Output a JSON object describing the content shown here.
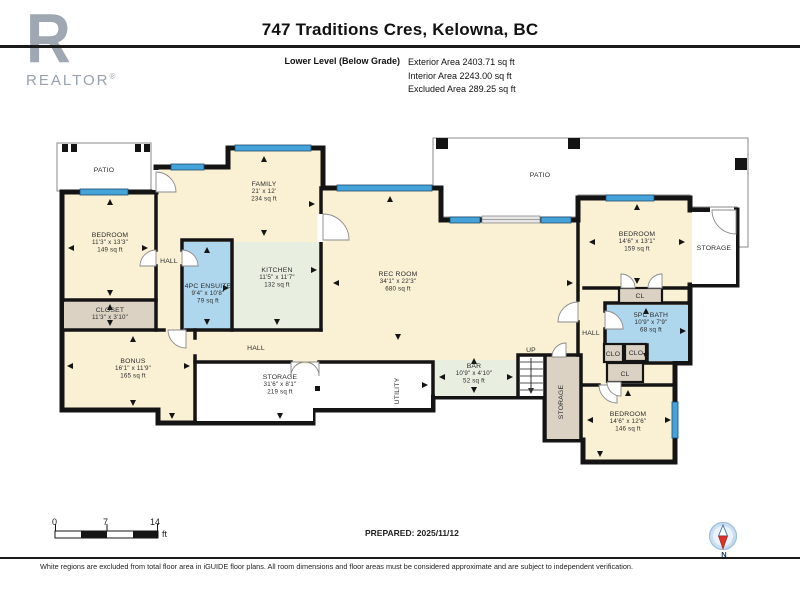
{
  "header": {
    "brand": "REALTOR",
    "brand_reg": "®",
    "brand_r": "R",
    "title": "747 Traditions Cres, Kelowna, BC",
    "level_label": "Lower Level (Below Grade)",
    "areas": [
      {
        "label": "Exterior Area",
        "value": "2403.71 sq ft"
      },
      {
        "label": "Interior Area",
        "value": "2243.00 sq ft"
      },
      {
        "label": "Excluded Area",
        "value": "289.25 sq ft"
      }
    ]
  },
  "floorplan": {
    "colors": {
      "wall": "#141414",
      "interior": "#FAF1D4",
      "wet_room": "#AED7EE",
      "kitchen_bar": "#E8EFE1",
      "closet": "#DBD2C3",
      "excluded": "#FFFFFF",
      "window": "#44A3D8",
      "sliding_door": "#E6E6E6"
    },
    "rooms": [
      {
        "name": "PATIO",
        "x": 104,
        "y": 172,
        "fs": 6.5
      },
      {
        "name": "PATIO",
        "x": 540,
        "y": 177,
        "fs": 6.5
      },
      {
        "name": "BEDROOM",
        "dims": "11'3\" x 13'3\"",
        "area": "149 sq ft",
        "x": 110,
        "y": 237
      },
      {
        "name": "HALL",
        "x": 169,
        "y": 263
      },
      {
        "name": "CLOSET",
        "dims": "11'3\" x 3'10\"",
        "x": 110,
        "y": 312
      },
      {
        "name": "4PC ENSUITE",
        "dims": "9'4\" x 10'8\"",
        "area": "79 sq ft",
        "x": 208,
        "y": 288
      },
      {
        "name": "KITCHEN",
        "dims": "11'5\" x 11'7\"",
        "area": "132 sq ft",
        "x": 277,
        "y": 272
      },
      {
        "name": "FAMILY",
        "dims": "21' x 12'",
        "area": "234 sq ft",
        "x": 264,
        "y": 186
      },
      {
        "name": "REC ROOM",
        "dims": "34'1\" x 22'3\"",
        "area": "680 sq ft",
        "x": 398,
        "y": 276
      },
      {
        "name": "BONUS",
        "dims": "16'1\" x 11'9\"",
        "area": "165 sq ft",
        "x": 133,
        "y": 363
      },
      {
        "name": "HALL",
        "x": 256,
        "y": 350
      },
      {
        "name": "STORAGE",
        "dims": "31'6\" x 8'1\"",
        "area": "219 sq ft",
        "x": 280,
        "y": 379
      },
      {
        "name": "UTILITY",
        "x": 399,
        "y": 391,
        "rot": -90
      },
      {
        "name": "BAR",
        "dims": "10'9\" x 4'10\"",
        "area": "52 sq ft",
        "x": 474,
        "y": 368
      },
      {
        "name": "UP",
        "x": 531,
        "y": 352,
        "fs": 6.5
      },
      {
        "name": "STORAGE",
        "x": 563,
        "y": 402,
        "rot": -90
      },
      {
        "name": "BEDROOM",
        "dims": "14'6\" x 13'1\"",
        "area": "159 sq ft",
        "x": 637,
        "y": 236
      },
      {
        "name": "STORAGE",
        "x": 714,
        "y": 250
      },
      {
        "name": "CL",
        "x": 640,
        "y": 298,
        "fs": 6
      },
      {
        "name": "HALL",
        "x": 591,
        "y": 335
      },
      {
        "name": "5PC BATH",
        "dims": "10'9\" x 7'9\"",
        "area": "68 sq ft",
        "x": 651,
        "y": 317
      },
      {
        "name": "CLO",
        "x": 613,
        "y": 356,
        "fs": 6
      },
      {
        "name": "CLO",
        "x": 636,
        "y": 355,
        "fs": 6
      },
      {
        "name": "CL",
        "x": 625,
        "y": 376,
        "fs": 6
      },
      {
        "name": "BEDROOM",
        "dims": "14'6\" x 12'6\"",
        "area": "146 sq ft",
        "x": 628,
        "y": 416
      }
    ]
  },
  "scale_bar": {
    "tick0": "0",
    "tick1": "7",
    "tick2": "14",
    "unit": "ft"
  },
  "prepared_label": "PREPARED: 2025/11/12",
  "compass": {
    "label": "N"
  },
  "disclaimer": "White regions are excluded from total floor area in iGUIDE floor plans. All room dimensions and floor areas must be considered approximate and are subject to independent verification."
}
